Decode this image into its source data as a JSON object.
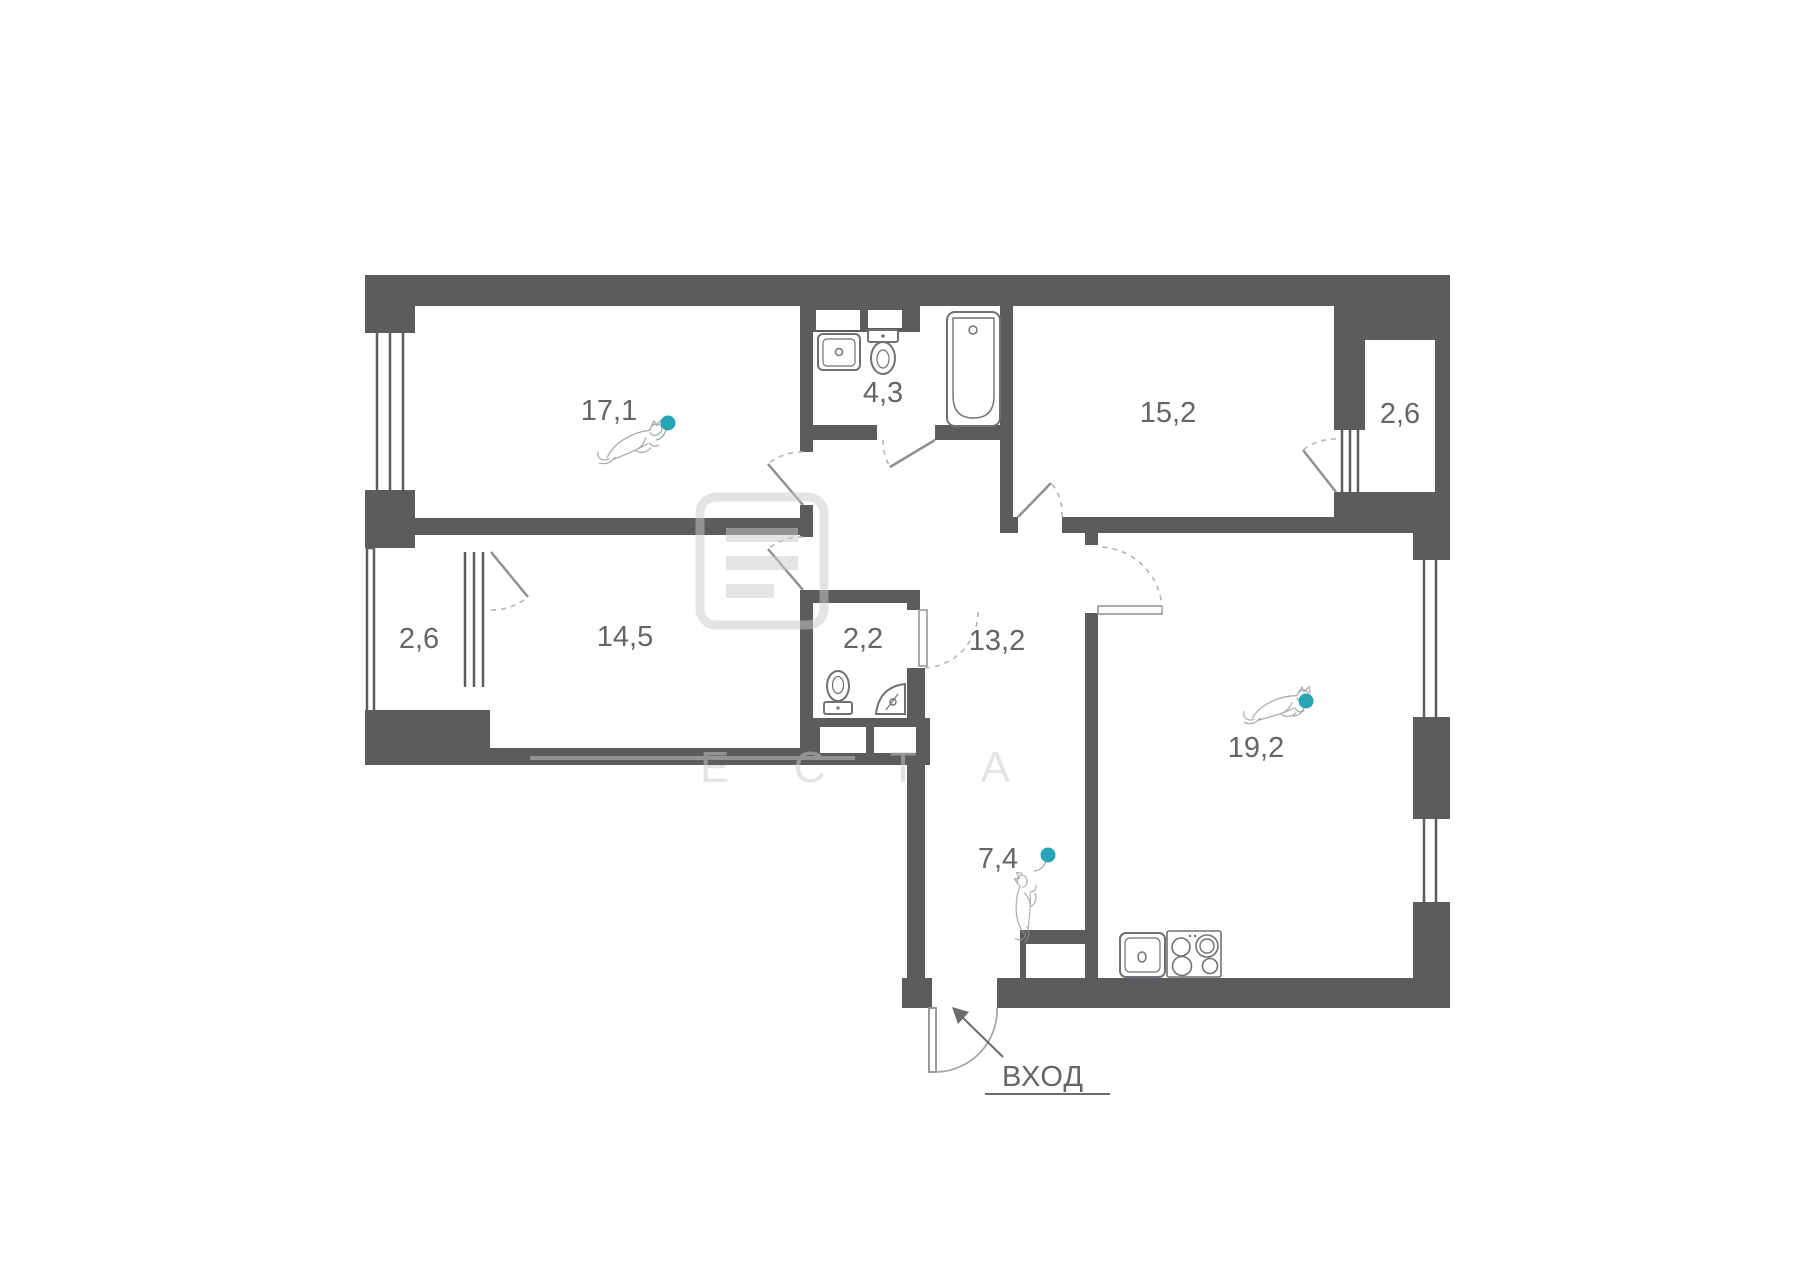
{
  "plan": {
    "colors": {
      "wall": "#5B5C5E",
      "label": "#646567",
      "marker": "#27A5B5",
      "fixture": "#707174",
      "door_arc": "#B5B5B5",
      "watermark": "#C9C9C9"
    },
    "rooms": [
      {
        "name": "living-room",
        "area": "17,1"
      },
      {
        "name": "bathroom",
        "area": "4,3"
      },
      {
        "name": "bedroom",
        "area": "15,2"
      },
      {
        "name": "balcony-top-right",
        "area": "2,6"
      },
      {
        "name": "bedroom-2",
        "area": "14,5"
      },
      {
        "name": "balcony-left",
        "area": "2,6"
      },
      {
        "name": "wc",
        "area": "2,2"
      },
      {
        "name": "hallway",
        "area": "13,2"
      },
      {
        "name": "kitchen-living",
        "area": "19,2"
      },
      {
        "name": "entry-hall",
        "area": "7,4"
      }
    ],
    "entrance_label": "ВХОД",
    "watermark": {
      "letters": "Е С Т А"
    }
  }
}
